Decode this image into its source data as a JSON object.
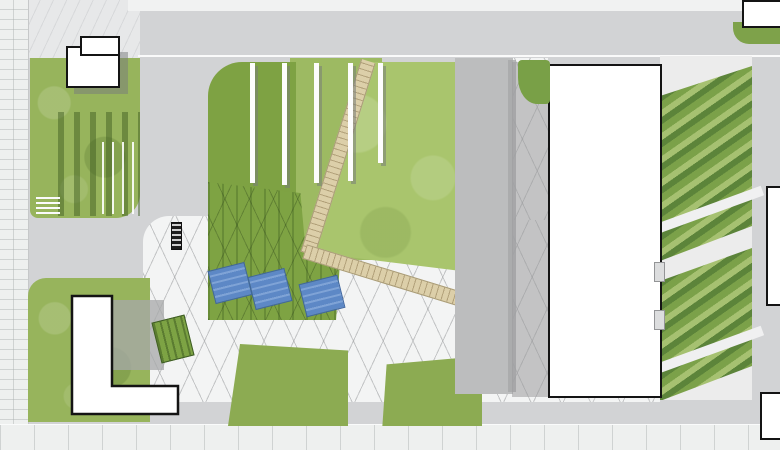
{
  "labels": {
    "grass": "grass"
  },
  "markers": [
    {
      "id": "01",
      "x": 94,
      "y": 171,
      "variant": "red"
    },
    {
      "id": "02",
      "x": 148,
      "y": 242,
      "variant": "red"
    },
    {
      "id": "03",
      "x": 171,
      "y": 339,
      "variant": "red"
    },
    {
      "id": "04",
      "x": 219,
      "y": 282,
      "variant": "red"
    },
    {
      "id": "05",
      "x": 333,
      "y": 141,
      "variant": "red"
    },
    {
      "id": "06",
      "x": 330,
      "y": 247,
      "variant": "red"
    },
    {
      "id": "07",
      "x": 331,
      "y": 387,
      "variant": "red"
    },
    {
      "id": "10",
      "x": 430,
      "y": 195,
      "variant": "red"
    },
    {
      "id": "11",
      "x": 334,
      "y": 89,
      "variant": "red"
    },
    {
      "id": "13",
      "x": 711,
      "y": 191,
      "variant": "red"
    },
    {
      "id": "",
      "x": 508,
      "y": 194,
      "variant": "pink"
    },
    {
      "id": "",
      "x": 673,
      "y": 234,
      "variant": "pink"
    },
    {
      "id": "",
      "x": 744,
      "y": 233,
      "variant": "pink"
    },
    {
      "id": "",
      "x": 328,
      "y": 341,
      "variant": "pink"
    },
    {
      "id": "",
      "x": 506,
      "y": 340,
      "variant": "pink"
    },
    {
      "id": "",
      "x": 745,
      "y": 317,
      "variant": "pink"
    }
  ],
  "colors": {
    "marker_red": "#cf4434",
    "marker_pink": "#ee8181",
    "grass": "#a9c56d",
    "lawn": "#97b45c",
    "tree": "#5f8136",
    "water": "#5d88c6",
    "road": "#d2d3d5",
    "plaza": "#f3f4f4",
    "path_tan": "#dccfa9",
    "building": "#ffffff",
    "outline": "#141414"
  }
}
